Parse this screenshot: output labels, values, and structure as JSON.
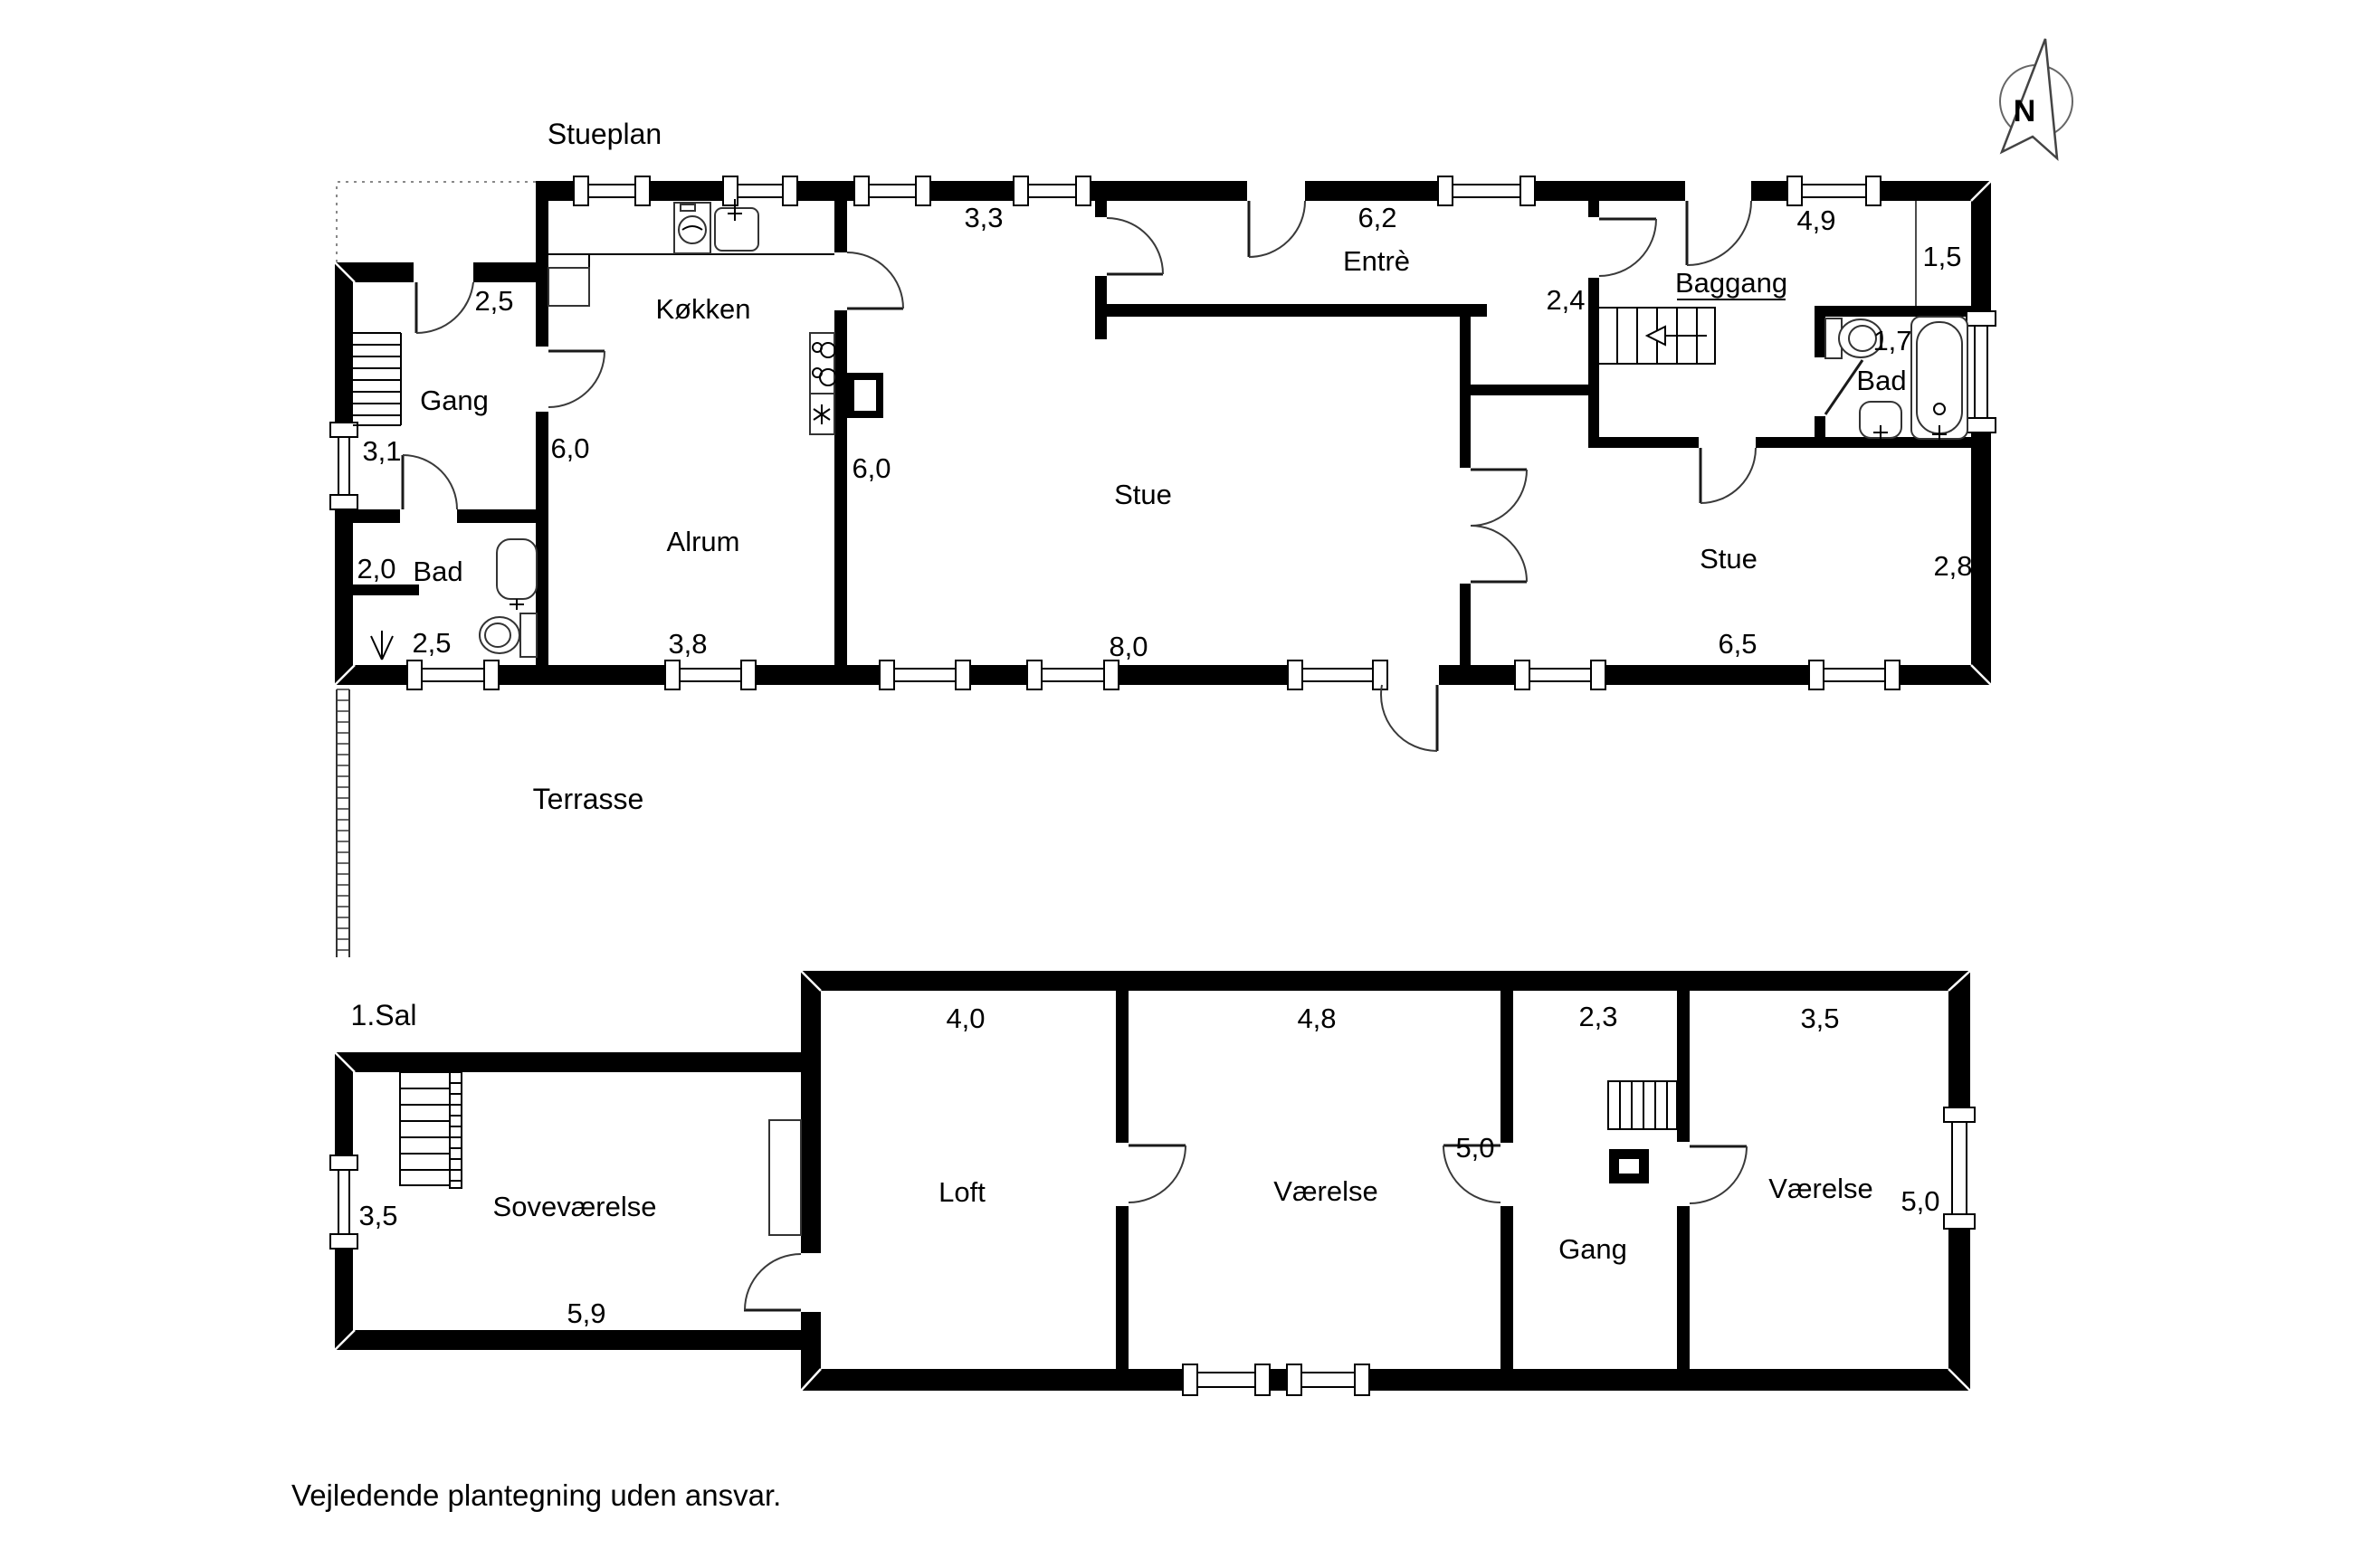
{
  "page": {
    "background": "#ffffff",
    "disclaimer": "Vejledende plantegning uden ansvar."
  },
  "compass": {
    "label": "N"
  },
  "ground_floor": {
    "title": "Stueplan",
    "terrace_label": "Terrasse",
    "rooms": {
      "gang": "Gang",
      "bad_left": "Bad",
      "kokken": "Køkken",
      "alrum": "Alrum",
      "stue_left": "Stue",
      "entre": "Entrè",
      "baggang": "Baggang",
      "bad_right": "Bad",
      "stue_right": "Stue"
    },
    "dims": {
      "gang_door": "2,5",
      "gang_window": "3,1",
      "bad_left_width": "2,0",
      "bad_left_bottom": "2,5",
      "kokken_left": "6,0",
      "kokken_top": "3,3",
      "alrum_bottom": "3,8",
      "stue_left_side": "6,0",
      "stue_left_bottom": "8,0",
      "entre_top": "6,2",
      "entre_passage": "2,4",
      "baggang_top": "4,9",
      "niche_width": "1,5",
      "bad_right_width": "1,7",
      "stue_right_side": "2,8",
      "stue_right_bottom": "6,5"
    }
  },
  "first_floor": {
    "title": "1.Sal",
    "rooms": {
      "sovevaerelse": "Soveværelse",
      "loft": "Loft",
      "vaerelse_mid": "Værelse",
      "gang": "Gang",
      "vaerelse_right": "Værelse"
    },
    "dims": {
      "loft_top": "4,0",
      "vaerelse_mid_top": "4,8",
      "gang_top": "2,3",
      "vaerelse_right_top": "3,5",
      "sovevaerelse_window": "3,5",
      "sovevaerelse_bottom": "5,9",
      "vaerelse_mid_side": "5,0",
      "vaerelse_right_side": "5,0"
    }
  },
  "colors": {
    "wall": "#000000",
    "line": "#000000",
    "thin_line": "#555555",
    "dotted": "#888888",
    "background": "#ffffff"
  }
}
